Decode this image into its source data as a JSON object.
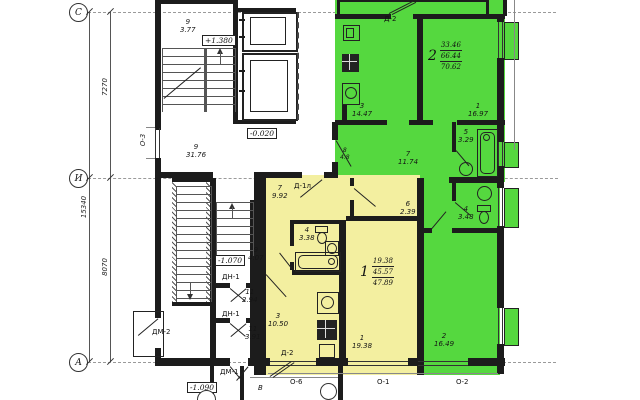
{
  "colors": {
    "highlight_green": "#55d83f",
    "highlight_yellow": "#f3efa0",
    "wall": "#1c1c1c"
  },
  "axis": {
    "c": "С",
    "i": "И",
    "a": "А",
    "dim_total": "15340",
    "dim_ci": "7270",
    "dim_ia": "8070"
  },
  "marks": {
    "lvl_stair": "+1.380",
    "lvl_floor": "-0.020",
    "lvl_mid": "-1.070",
    "lvl_entry": "-1.090",
    "d2_top": "Д-2",
    "d1l": "Д-1л",
    "d2_low": "Д-2",
    "dn1a": "ДН-1",
    "dn1b": "ДН-1",
    "dm1": "ДМ-1",
    "dm2": "ДМ-2",
    "o3": "О-3",
    "o6": "О-6",
    "o1": "О-1",
    "o2": "О-2",
    "vest": "В"
  },
  "common": {
    "stair_top": {
      "n": "9",
      "a": "3.77"
    },
    "corridor": {
      "n": "9",
      "a": "31.76"
    },
    "stair_low": {
      "n": "9",
      "a": "4.07"
    },
    "lobby1": {
      "n": "11",
      "a": "2.94"
    },
    "lobby2": {
      "n": "11",
      "a": "3.91"
    }
  },
  "apt2": {
    "num": "2",
    "s1": "33.46",
    "s2": "66.44",
    "s3": "70.62",
    "kitchen": {
      "n": "3",
      "a": "14.47"
    },
    "living": {
      "n": "1",
      "a": "16.97"
    },
    "hall": {
      "n": "7",
      "a": "11.74"
    },
    "bath": {
      "n": "5",
      "a": "3.29"
    },
    "wc": {
      "n": "4",
      "a": "3.48"
    },
    "bedroom": {
      "n": "2",
      "a": "16.49"
    },
    "niche": {
      "n": "8",
      "a": "4.8"
    }
  },
  "apt1": {
    "num": "1",
    "s1": "19.38",
    "s2": "45.57",
    "s3": "47.89",
    "hall": {
      "n": "7",
      "a": "9.92"
    },
    "bath": {
      "n": "4",
      "a": "3.38"
    },
    "storage": {
      "n": "6",
      "a": "2.39"
    },
    "kitchen": {
      "n": "3",
      "a": "10.50"
    },
    "living": {
      "n": "1",
      "a": "19.38"
    }
  }
}
